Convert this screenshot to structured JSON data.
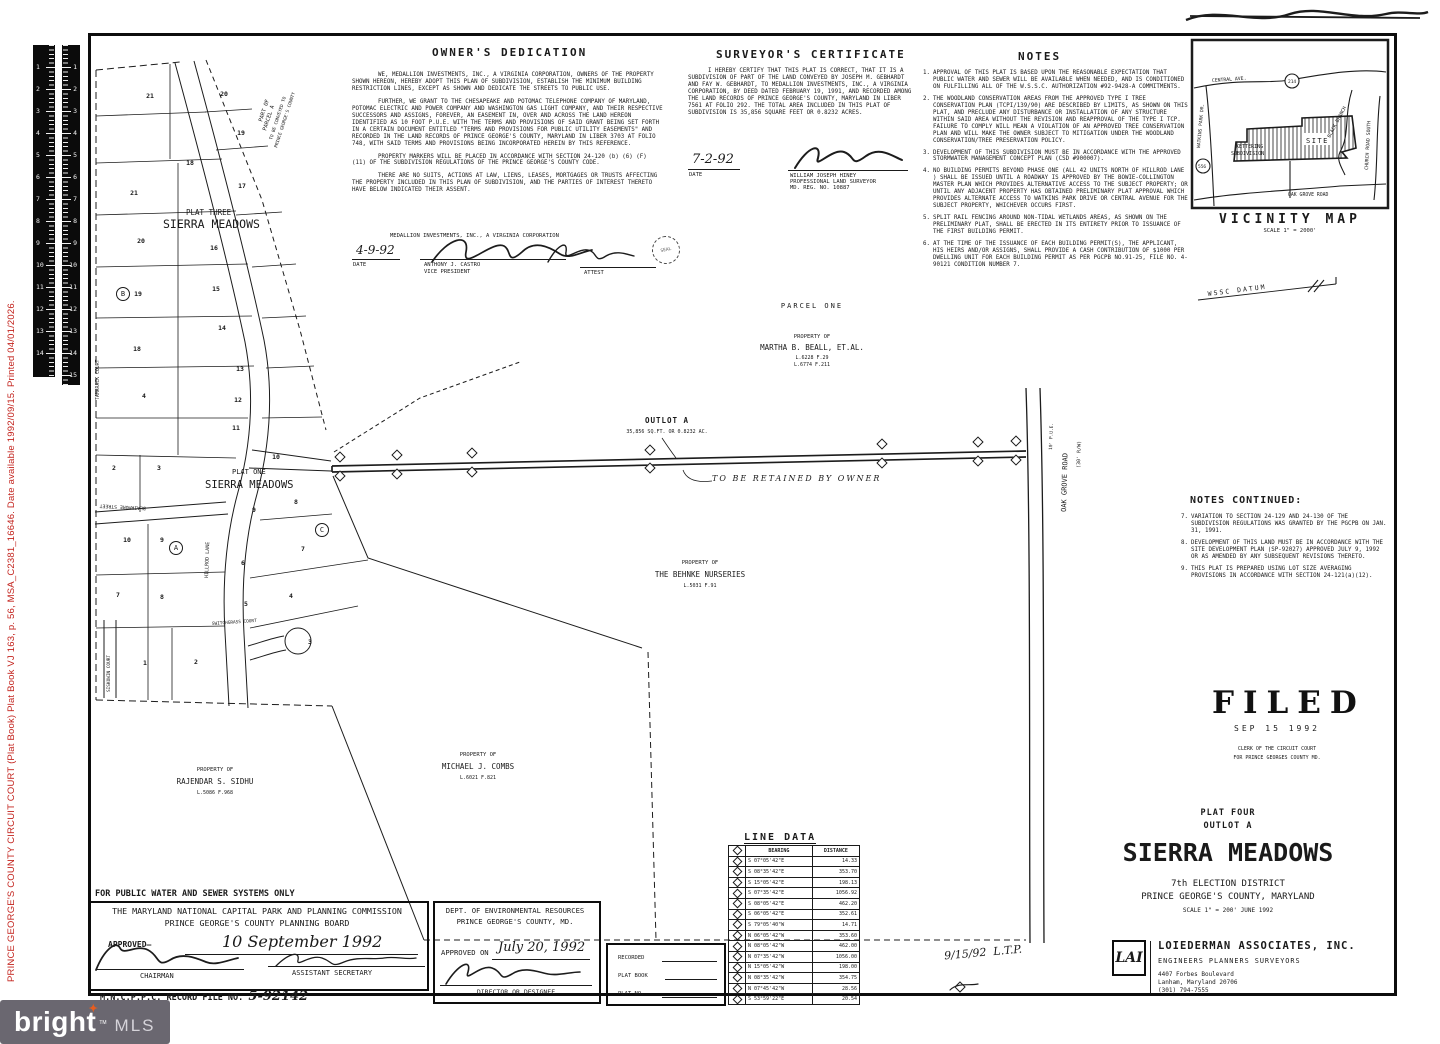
{
  "archive_strip": {
    "text": "PRINCE GEORGE'S COUNTY CIRCUIT COURT (Plat Book) Plat Book VJ 163, p. 56, MSA_C2381_16646. Date available 1992/09/15. Printed 04/01/2026.",
    "color": "#c3231d"
  },
  "ruler": {
    "numbers": [
      "1",
      "2",
      "3",
      "4",
      "5",
      "6",
      "7",
      "8",
      "9",
      "10",
      "11",
      "12",
      "13",
      "14",
      "15"
    ]
  },
  "owners_dedication": {
    "title": "OWNER'S DEDICATION",
    "paragraphs": [
      "WE, MEDALLION INVESTMENTS, INC., A VIRGINIA CORPORATION, OWNERS OF THE PROPERTY SHOWN HEREON, HEREBY ADOPT THIS PLAN OF SUBDIVISION, ESTABLISH THE MINIMUM BUILDING RESTRICTION LINES, EXCEPT AS SHOWN AND DEDICATE THE STREETS TO PUBLIC USE.",
      "FURTHER, WE GRANT TO THE CHESAPEAKE AND POTOMAC TELEPHONE COMPANY OF MARYLAND, POTOMAC ELECTRIC AND POWER COMPANY AND WASHINGTON GAS LIGHT COMPANY, AND THEIR RESPECTIVE SUCCESSORS AND ASSIGNS, FOREVER, AN EASEMENT IN, OVER AND ACROSS THE LAND HEREON IDENTIFIED AS 10 FOOT P.U.E. WITH THE TERMS AND PROVISIONS OF SAID GRANT BEING SET FORTH IN A CERTAIN DOCUMENT ENTITLED \"TERMS AND PROVISIONS FOR PUBLIC UTILITY EASEMENTS\" AND RECORDED IN THE LAND RECORDS OF PRINCE GEORGE'S COUNTY, MARYLAND IN LIBER 3703 AT FOLIO 748, WITH SAID TERMS AND PROVISIONS BEING INCORPORATED HEREIN BY THIS REFERENCE.",
      "PROPERTY MARKERS WILL BE PLACED IN ACCORDANCE WITH SECTION 24-120 (b) (6) (F) (11) OF THE SUBDIVISION REGULATIONS OF THE PRINCE GEORGE'S COUNTY CODE.",
      "THERE ARE NO SUITS, ACTIONS AT LAW, LIENS, LEASES, MORTGAGES OR TRUSTS AFFECTING THE PROPERTY INCLUDED IN THIS PLAN OF SUBDIVISION, AND THE PARTIES OF INTEREST THERETO HAVE BELOW INDICATED THEIR ASSENT."
    ],
    "corp_line": "MEDALLION INVESTMENTS, INC., A VIRGINIA CORPORATION",
    "date": "4-9-92",
    "date_label": "DATE",
    "signer_name": "ANTHONY J. CASTRO",
    "signer_title": "VICE PRESIDENT",
    "attest_label": "ATTEST",
    "seal_label": "SEAL"
  },
  "surveyors_certificate": {
    "title": "SURVEYOR'S CERTIFICATE",
    "body": "I HEREBY CERTIFY THAT THIS PLAT IS CORRECT, THAT IT IS A SUBDIVISION OF PART OF THE LAND CONVEYED BY JOSEPH M. GEBHARDT AND FAY W. GEBHARDT, TO MEDALLION INVESTMENTS, INC., A VIRGINIA CORPORATION, BY DEED DATED FEBRUARY 19, 1991, AND RECORDED AMONG THE LAND RECORDS OF PRINCE GEORGE'S COUNTY, MARYLAND IN LIBER 7561 AT FOLIO 292. THE TOTAL AREA INCLUDED IN THIS PLAT OF SUBDIVISION IS 35,856 SQUARE FEET OR 0.8232 ACRES.",
    "date": "7-2-92",
    "date_label": "DATE",
    "surveyor_name": "WILLIAM JOSEPH HINEY",
    "surveyor_title": "PROFESSIONAL LAND SURVEYOR",
    "surveyor_reg": "MD. REG. NO. 10887"
  },
  "notes": {
    "title": "NOTES",
    "items": [
      {
        "n": "1.",
        "t": "APPROVAL OF THIS PLAT IS BASED UPON THE REASONABLE EXPECTATION THAT PUBLIC WATER AND SEWER WILL BE AVAILABLE WHEN NEEDED, AND IS CONDITIONED ON FULFILLING ALL OF THE W.S.S.C. AUTHORIZATION #92-9428-A COMMITMENTS."
      },
      {
        "n": "2.",
        "t": "THE WOODLAND CONSERVATION AREAS FROM THE APPROVED TYPE I TREE CONSERVATION PLAN (TCPI/139/90) ARE DESCRIBED BY LIMITS, AS SHOWN ON THIS PLAT, AND PRECLUDE ANY DISTURBANCE OR INSTALLATION OF ANY STRUCTURE WITHIN SAID AREA WITHOUT THE REVISION AND REAPPROVAL OF THE TYPE I TCP. FAILURE TO COMPLY WILL MEAN A VIOLATION OF AN APPROVED TREE CONSERVATION PLAN AND WILL MAKE THE OWNER SUBJECT TO MITIGATION UNDER THE WOODLAND CONSERVATION/TREE PRESERVATION POLICY."
      },
      {
        "n": "3.",
        "t": "DEVELOPMENT OF THIS SUBDIVISION MUST BE IN ACCORDANCE WITH THE APPROVED STORMWATER MANAGEMENT CONCEPT PLAN (CSD #900007)."
      },
      {
        "n": "4.",
        "t": "NO BUILDING PERMITS BEYOND PHASE ONE (ALL 42 UNITS NORTH OF HILLROD LANE ) SHALL BE ISSUED UNTIL A ROADWAY IS APPROVED BY THE BOWIE-COLLINGTON MASTER PLAN WHICH PROVIDES ALTERNATIVE ACCESS TO THE SUBJECT PROPERTY; OR UNTIL ANY ADJACENT PROPERTY HAS OBTAINED PRELIMINARY PLAT APPROVAL WHICH PROVIDES ALTERNATE ACCESS TO WATKINS PARK DRIVE OR CENTRAL AVENUE FOR THE SUBJECT PROPERTY, WHICHEVER OCCURS FIRST."
      },
      {
        "n": "5.",
        "t": "SPLIT RAIL FENCING AROUND NON-TIDAL WETLANDS AREAS, AS SHOWN ON THE PRELIMINARY PLAT, SHALL BE ERECTED IN ITS ENTIRETY PRIOR TO ISSUANCE OF THE FIRST BUILDING PERMIT."
      },
      {
        "n": "6.",
        "t": "AT THE TIME OF THE ISSUANCE OF EACH BUILDING PERMIT(S), THE APPLICANT, HIS HEIRS AND/OR ASSIGNS, SHALL PROVIDE A CASH CONTRIBUTION OF $1000 PER DWELLING UNIT FOR EACH BUILDING PERMIT AS PER PGCPB NO.91-25, FILE NO. 4-90121 CONDITION NUMBER 7."
      }
    ]
  },
  "notes_continued": {
    "title": "NOTES CONTINUED:",
    "items": [
      {
        "n": "7.",
        "t": "VARIATION TO SECTION 24-129 AND 24-130 OF THE SUBDIVISION REGULATIONS WAS GRANTED BY THE PGCPB ON JAN. 31, 1991."
      },
      {
        "n": "8.",
        "t": "DEVELOPMENT OF THIS LAND MUST BE IN ACCORDANCE WITH THE SITE DEVELOPMENT PLAN (SP-92027) APPROVED JULY 9, 1992 OR AS AMENDED BY ANY SUBSEQUENT REVISIONS THERETO."
      },
      {
        "n": "9.",
        "t": "THIS PLAT IS PREPARED USING LOT SIZE AVERAGING PROVISIONS IN ACCORDANCE WITH SECTION 24-121(a)(12)."
      }
    ]
  },
  "vicinity": {
    "title": "VICINITY MAP",
    "scale": "SCALE 1\" = 2000'",
    "central": "CENTRAL AVE.",
    "route214": "214",
    "watkins": "WATKINS PARK DR.",
    "route556": "556",
    "kettering1": "KETTERING",
    "kettering2": "SUBDIVISION",
    "black_branch": "BLACK BRANCH",
    "church": "CHURCH ROAD SOUTH",
    "site": "SITE",
    "oak_grove": "OAK GROVE ROAD"
  },
  "map": {
    "parcel_one": "PARCEL ONE",
    "beall": {
      "p": "PROPERTY OF",
      "n": "MARTHA B. BEALL, ET.AL.",
      "l1": "L.6228 F.29",
      "l2": "L.6774 F.211"
    },
    "behnke": {
      "p": "PROPERTY OF",
      "n": "THE BEHNKE NURSERIES",
      "l": "L.5031 F.91"
    },
    "sidhu": {
      "p": "PROPERTY OF",
      "n": "RAJENDAR S. SIDHU",
      "l": "L.5086 F.968"
    },
    "combs": {
      "p": "PROPERTY OF",
      "n": "MICHAEL J. COMBS",
      "l": "L.6021 F.821"
    },
    "outlot": {
      "n": "OUTLOT A",
      "a": "35,856 SQ.FT. OR 0.8232 AC.",
      "r": "TO BE RETAINED BY OWNER",
      "pue": "10' P.U.E."
    },
    "oak": {
      "n": "OAK GROVE ROAD",
      "rw": "(30' R/W)"
    },
    "wssc": "WSSC DATUM",
    "plat_three1": "PLAT THREE",
    "plat_three2": "SIERRA MEADOWS",
    "plat_one1": "PLAT ONE",
    "plat_one2": "SIERRA MEADOWS",
    "pa": {
      "l1": "PART OF",
      "l2": "PARCEL A",
      "l3": "TO BE CONVEYED TO",
      "l4": "PRINCE GEORGE'S COUNTY"
    },
    "streets": {
      "tamarack": "TAMARACK COURT",
      "blairmore": "BLAIRMORE STREET",
      "hillrod": "HILLROD LANE",
      "siskowin": "SISKOWIN COURT",
      "switchgrass": "SWITCHGRASS COURT"
    },
    "lot_numbers": [
      {
        "n": "21",
        "x": 150,
        "y": 96
      },
      {
        "n": "20",
        "x": 224,
        "y": 94
      },
      {
        "n": "19",
        "x": 241,
        "y": 133
      },
      {
        "n": "18",
        "x": 190,
        "y": 163
      },
      {
        "n": "17",
        "x": 242,
        "y": 186
      },
      {
        "n": "21",
        "x": 134,
        "y": 193
      },
      {
        "n": "20",
        "x": 141,
        "y": 241
      },
      {
        "n": "16",
        "x": 214,
        "y": 248
      },
      {
        "n": "15",
        "x": 216,
        "y": 289
      },
      {
        "n": "19",
        "x": 138,
        "y": 294
      },
      {
        "n": "14",
        "x": 222,
        "y": 328
      },
      {
        "n": "18",
        "x": 137,
        "y": 349
      },
      {
        "n": "13",
        "x": 240,
        "y": 369
      },
      {
        "n": "4",
        "x": 144,
        "y": 396
      },
      {
        "n": "12",
        "x": 238,
        "y": 400
      },
      {
        "n": "11",
        "x": 236,
        "y": 428
      },
      {
        "n": "10",
        "x": 276,
        "y": 457
      },
      {
        "n": "2",
        "x": 114,
        "y": 468
      },
      {
        "n": "3",
        "x": 159,
        "y": 468
      },
      {
        "n": "9",
        "x": 254,
        "y": 510
      },
      {
        "n": "8",
        "x": 296,
        "y": 502
      },
      {
        "n": "10",
        "x": 127,
        "y": 540
      },
      {
        "n": "9",
        "x": 162,
        "y": 540
      },
      {
        "n": "7",
        "x": 303,
        "y": 549
      },
      {
        "n": "6",
        "x": 243,
        "y": 563
      },
      {
        "n": "7",
        "x": 118,
        "y": 595
      },
      {
        "n": "8",
        "x": 162,
        "y": 597
      },
      {
        "n": "5",
        "x": 246,
        "y": 604
      },
      {
        "n": "4",
        "x": 291,
        "y": 596
      },
      {
        "n": "3",
        "x": 310,
        "y": 642
      },
      {
        "n": "1",
        "x": 145,
        "y": 663
      },
      {
        "n": "2",
        "x": 196,
        "y": 662
      }
    ],
    "circled": [
      {
        "t": "A",
        "x": 176,
        "y": 548
      },
      {
        "t": "B",
        "x": 123,
        "y": 294
      },
      {
        "t": "C",
        "x": 322,
        "y": 530
      }
    ],
    "outlot_marks": [
      {
        "x": 340,
        "y": 457
      },
      {
        "x": 340,
        "y": 476
      },
      {
        "x": 397,
        "y": 455
      },
      {
        "x": 397,
        "y": 474
      },
      {
        "x": 472,
        "y": 453
      },
      {
        "x": 472,
        "y": 472
      },
      {
        "x": 650,
        "y": 450
      },
      {
        "x": 650,
        "y": 468
      },
      {
        "x": 882,
        "y": 444
      },
      {
        "x": 882,
        "y": 463
      },
      {
        "x": 978,
        "y": 442
      },
      {
        "x": 978,
        "y": 461
      },
      {
        "x": 1016,
        "y": 441
      },
      {
        "x": 1016,
        "y": 460
      }
    ]
  },
  "line_data": {
    "title": "LINE DATA",
    "headers": [
      "BEARING",
      "DISTANCE"
    ],
    "rows": [
      [
        "S 07°05'42\"E",
        "14.33"
      ],
      [
        "S 08°35'42\"E",
        "353.70"
      ],
      [
        "S 15°05'42\"E",
        "198.13"
      ],
      [
        "S 07°35'42\"E",
        "1056.92"
      ],
      [
        "S 08°05'42\"E",
        "462.20"
      ],
      [
        "S 06°05'42\"E",
        "352.61"
      ],
      [
        "S 79°05'40\"W",
        "14.71"
      ],
      [
        "N 06°05'42\"W",
        "353.60"
      ],
      [
        "N 08°05'42\"W",
        "462.00"
      ],
      [
        "N 07°35'42\"W",
        "1056.00"
      ],
      [
        "N 15°05'42\"W",
        "198.00"
      ],
      [
        "N 08°35'42\"W",
        "354.75"
      ],
      [
        "N 07°45'42\"W",
        "28.56"
      ],
      [
        "S 53°59'22\"E",
        "20.54"
      ]
    ]
  },
  "recorded_box": {
    "recorded": "RECORDED",
    "plat_book": "PLAT BOOK",
    "plat_no": "PLAT NO."
  },
  "filed": {
    "word": "FILED",
    "date": "SEP 15 1992",
    "l1": "CLERK OF THE CIRCUIT COURT",
    "l2": "FOR PRINCE GEORGES COUNTY MD."
  },
  "title_block": {
    "plat": "PLAT FOUR",
    "outlot": "OUTLOT A",
    "name": "SIERRA MEADOWS",
    "district": "7th ELECTION DISTRICT",
    "county": "PRINCE GEORGE'S COUNTY,  MARYLAND",
    "scale_date": "SCALE 1\" = 200'      JUNE 1992"
  },
  "handnote": {
    "d": "9/15/92",
    "init": "L.T.P."
  },
  "firm": {
    "logo": "LAI",
    "name": "LOIEDERMAN ASSOCIATES, INC.",
    "roles": "ENGINEERS    PLANNERS    SURVEYORS",
    "addr1": "4407 Forbes Boulevard",
    "addr2": "Lanham, Maryland  20706",
    "phone": "(301) 794-7555"
  },
  "mncppc": {
    "above": "FOR PUBLIC WATER AND SEWER SYSTEMS ONLY",
    "l1": "THE MARYLAND NATIONAL CAPITAL PARK AND PLANNING COMMISSION",
    "l2": "PRINCE GEORGE'S COUNTY PLANNING BOARD",
    "approved": "APPROVED–",
    "date_script": "10 September 1992",
    "chairman": "CHAIRMAN",
    "asst": "ASSISTANT SECRETARY",
    "record": "M.N.C.P.P.C.  RECORD FILE NO.",
    "record_no": "5-92142"
  },
  "der": {
    "l1": "DEPT. OF ENVIRONMENTAL RESOURCES",
    "l2": "PRINCE GEORGE'S COUNTY, MD.",
    "approved": "APPROVED ON",
    "date_script": "July 20, 1992",
    "title": "DIRECTOR OR DESIGNEE"
  },
  "bright": {
    "word1": "bright",
    "word2": "MLS",
    "tm": "TM",
    "star": "✦",
    "bg": "#6a6770",
    "accent": "#e85d1f"
  }
}
